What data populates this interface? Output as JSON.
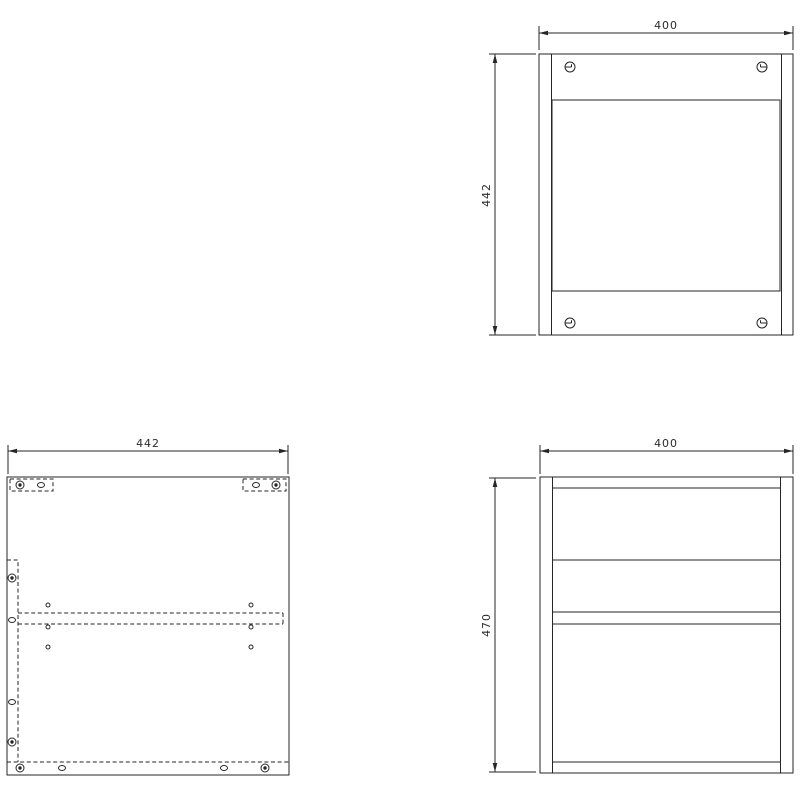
{
  "drawing": {
    "background": "#ffffff",
    "line_color": "#262626",
    "views": {
      "front": {
        "dim_width": "400",
        "dim_height": "442"
      },
      "plan": {
        "dim_width": "442"
      },
      "side": {
        "dim_width": "400",
        "dim_height": "470"
      }
    }
  }
}
